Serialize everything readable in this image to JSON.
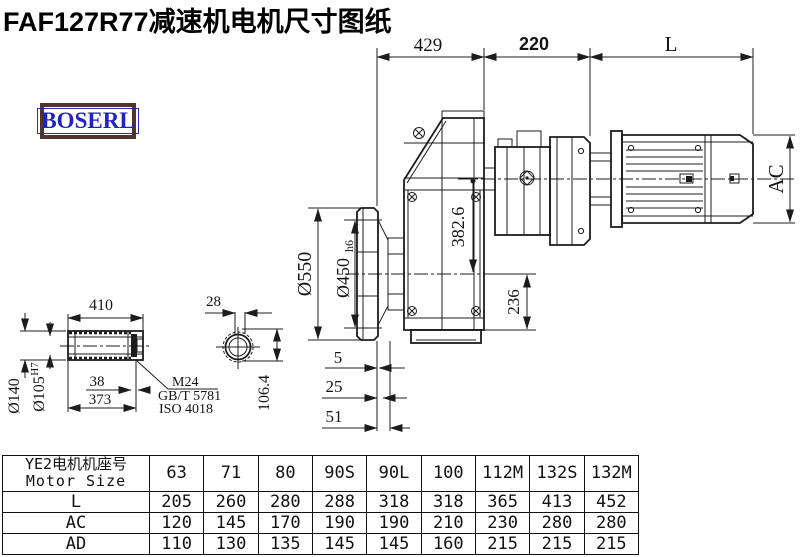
{
  "title": "FAF127R77减速机电机尺寸图纸",
  "logo": {
    "text": "BOSERL"
  },
  "colors": {
    "line": "#1c1c1c",
    "logo_text_blue": "#2122c4",
    "logo_border_brown": "#53342b"
  },
  "drawing": {
    "dims": {
      "d429": "429",
      "d220": "220",
      "dL": "L",
      "dAC": "AC",
      "d3826": "382.6",
      "d236": "236",
      "d550": "Ø550",
      "d450": "Ø450",
      "d450t": "h6",
      "d5": "5",
      "d25": "25",
      "d51": "51",
      "d410": "410",
      "d140": "Ø140",
      "d105": "Ø105",
      "d105t": "H7",
      "d38": "38",
      "d373": "373",
      "m24": "M24",
      "gb": "GB/T 5781",
      "iso": "ISO 4018",
      "d28": "28",
      "d1064": "106.4"
    }
  },
  "table": {
    "header_cn": "YE2电机机座号",
    "header_en": "Motor Size",
    "columns": [
      "63",
      "71",
      "80",
      "90S",
      "90L",
      "100",
      "112M",
      "132S",
      "132M"
    ],
    "rows": [
      {
        "label": "L",
        "values": [
          "205",
          "260",
          "280",
          "288",
          "318",
          "318",
          "365",
          "413",
          "452"
        ]
      },
      {
        "label": "AC",
        "values": [
          "120",
          "145",
          "170",
          "190",
          "190",
          "210",
          "230",
          "280",
          "280"
        ]
      },
      {
        "label": "AD",
        "values": [
          "110",
          "130",
          "135",
          "145",
          "145",
          "160",
          "215",
          "215",
          "215"
        ]
      }
    ]
  }
}
